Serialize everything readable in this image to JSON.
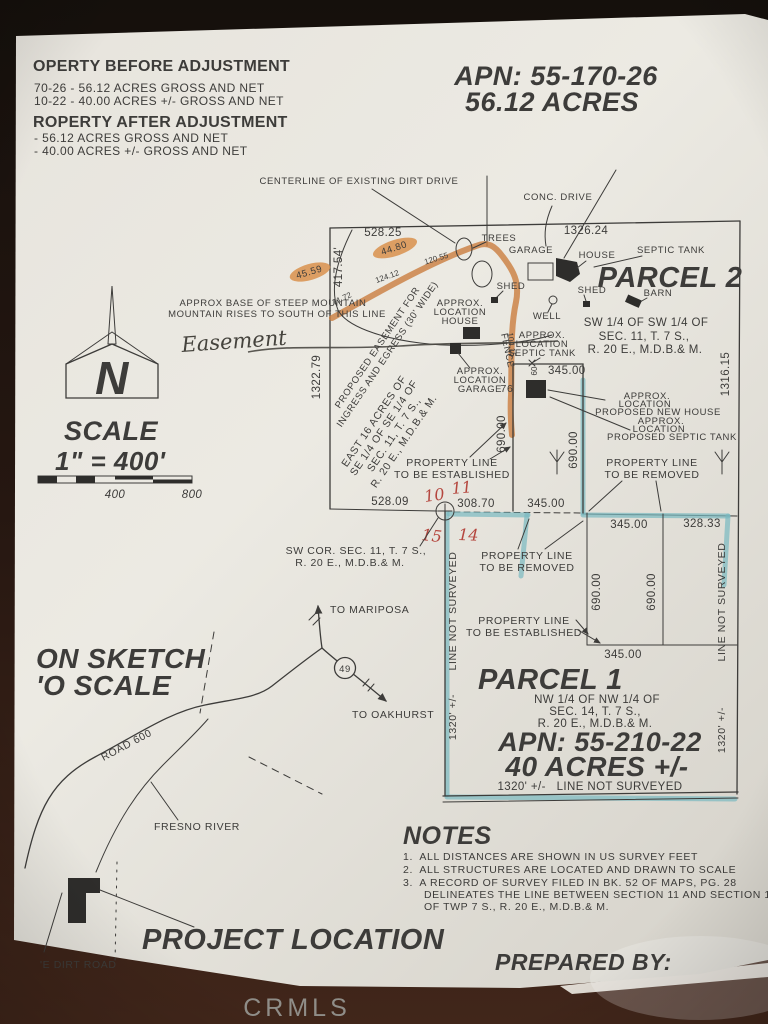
{
  "photo": {
    "watermark": "CRMLS"
  },
  "colors": {
    "paper": "#e9e6df",
    "ink": "#3d3c3a",
    "orange_highlight": "#cb7d3e",
    "teal_highlight": "#79b9c0",
    "red_ink": "#b5473f",
    "background": "#2a1a12"
  },
  "adjustments": {
    "before_title": "OPERTY BEFORE ADJUSTMENT",
    "before_lines": [
      "70-26 - 56.12 ACRES GROSS AND NET",
      "10-22 - 40.00 ACRES +/- GROSS AND NET"
    ],
    "after_title": "ROPERTY AFTER ADJUSTMENT",
    "after_lines": [
      "- 56.12 ACRES GROSS AND NET",
      "- 40.00 ACRES +/- GROSS AND NET"
    ]
  },
  "apn_block": {
    "apn": "APN: 55-170-26",
    "acres": "56.12 ACRES"
  },
  "parcel2": {
    "title": "PARCEL 2",
    "legal": [
      "SW 1/4 OF SW 1/4 OF",
      "SEC. 11, T. 7 S.,",
      "R. 20 E., M.D.B.& M."
    ],
    "east16": [
      "EAST 16 ACRES OF",
      "SE 1/4 OF SE 1/4 OF",
      "SEC. 11, T. 7 S.,",
      "R. 20 E., M.D.B.& M."
    ],
    "centerline_label": "CENTERLINE OF EXISTING DIRT DRIVE",
    "conc_drive": "CONC. DRIVE",
    "trees": "TREES",
    "garage": "GARAGE",
    "house": "HOUSE",
    "septic_tank": "SEPTIC TANK",
    "shed_left": "SHED",
    "shed_right": "SHED",
    "barn": "BARN",
    "well": "WELL",
    "fence": "FENCE",
    "mountain_note": [
      "APPROX BASE OF STEEP MOUNTAIN",
      "MOUNTAIN RISES TO SOUTH OF THIS LINE"
    ],
    "easement_handwritten": "Easement",
    "easement_note": [
      "PROPOSED EASEMENT FOR",
      "INGRESS AND EGRESS (30' WIDE)"
    ],
    "drive_dims": {
      "d1": "44.80",
      "d2": "45.59",
      "d3": "71.72",
      "d4": "124.12",
      "d5": "120.55",
      "d6": "104.15"
    },
    "dims": {
      "top_w": "528.25",
      "top_e": "1326.24",
      "w1": "417.54'",
      "w2": "1322.79",
      "e": "1316.15",
      "bot_w": "528.09",
      "bot_c": "308.70",
      "bot_e": "345.00"
    },
    "approx_house": [
      "APPROX.",
      "LOCATION",
      "HOUSE"
    ],
    "approx_garage": [
      "APPROX.",
      "LOCATION",
      "GARAGE"
    ],
    "approx_septic": [
      "APPROX.",
      "LOCATION",
      "SEPTIC TANK"
    ],
    "proposed_house": [
      "APPROX.",
      "LOCATION",
      "PROPOSED NEW HOUSE"
    ],
    "proposed_septic": [
      "APPROX.",
      "LOCATION",
      "PROPOSED SEPTIC TANK"
    ],
    "new_site": {
      "w": "345.00",
      "h_left": "690.00",
      "h_right": "690.00",
      "n60": "60",
      "n76": "76"
    },
    "line_established": [
      "PROPERTY LINE",
      "TO BE ESTABLISHED"
    ],
    "line_removed": [
      "PROPERTY LINE",
      "TO BE REMOVED"
    ],
    "sw_corner": [
      "SW COR. SEC. 11, T. 7 S.,",
      "R. 20 E., M.D.B.& M."
    ],
    "section_numbers": {
      "nw": "10",
      "ne": "11",
      "sw": "15",
      "se": "14"
    }
  },
  "parcel1": {
    "title": "PARCEL 1",
    "legal": [
      "NW 1/4 OF NW 1/4 OF",
      "SEC. 14, T. 7 S.,",
      "R. 20 E., M.D.B.& M."
    ],
    "apn": "APN: 55-210-22",
    "acres": "40 ACRES +/-",
    "bottom_note": "1320' +/-   LINE NOT SURVEYED",
    "west_label": "LINE NOT SURVEYED",
    "west_dim": "1320' +/-",
    "east_label": "LINE NOT SURVEYED",
    "east_dim": "1320' +/-",
    "line_removed": [
      "PROPERTY LINE",
      "TO BE REMOVED"
    ],
    "line_established": [
      "PROPERTY LINE",
      "TO BE ESTABLISHED"
    ],
    "dims": {
      "top_w": "345.00",
      "top_e": "328.33",
      "mid_w": "690.00",
      "mid_e": "690.00",
      "bot": "345.00"
    }
  },
  "scale": {
    "title": "SCALE",
    "ratio": "1\" = 400'",
    "tick_mid": "400",
    "tick_end": "800"
  },
  "compass": {
    "letter": "N"
  },
  "sketch": {
    "title_lines": [
      "ON SKETCH",
      "'O SCALE"
    ],
    "to_mariposa": "TO MARIPOSA",
    "highway": "49",
    "to_oakhurst": "TO OAKHURST",
    "road": "ROAD 600",
    "river": "FRESNO RIVER"
  },
  "notes": {
    "title": "NOTES",
    "items": [
      "1.  ALL DISTANCES ARE SHOWN IN US SURVEY FEET",
      "2.  ALL STRUCTURES ARE LOCATED AND DRAWN TO SCALE",
      "3.  A RECORD OF SURVEY FILED IN BK. 52 OF MAPS, PG. 28",
      "DELINEATES THE LINE BETWEEN SECTION 11 AND SECTION 14",
      "OF TWP 7 S., R. 20 E., M.D.B.& M."
    ]
  },
  "footer": {
    "dirt_road": "'E DIRT ROAD",
    "project_location": "PROJECT LOCATION",
    "prepared_by": "PREPARED BY:"
  }
}
